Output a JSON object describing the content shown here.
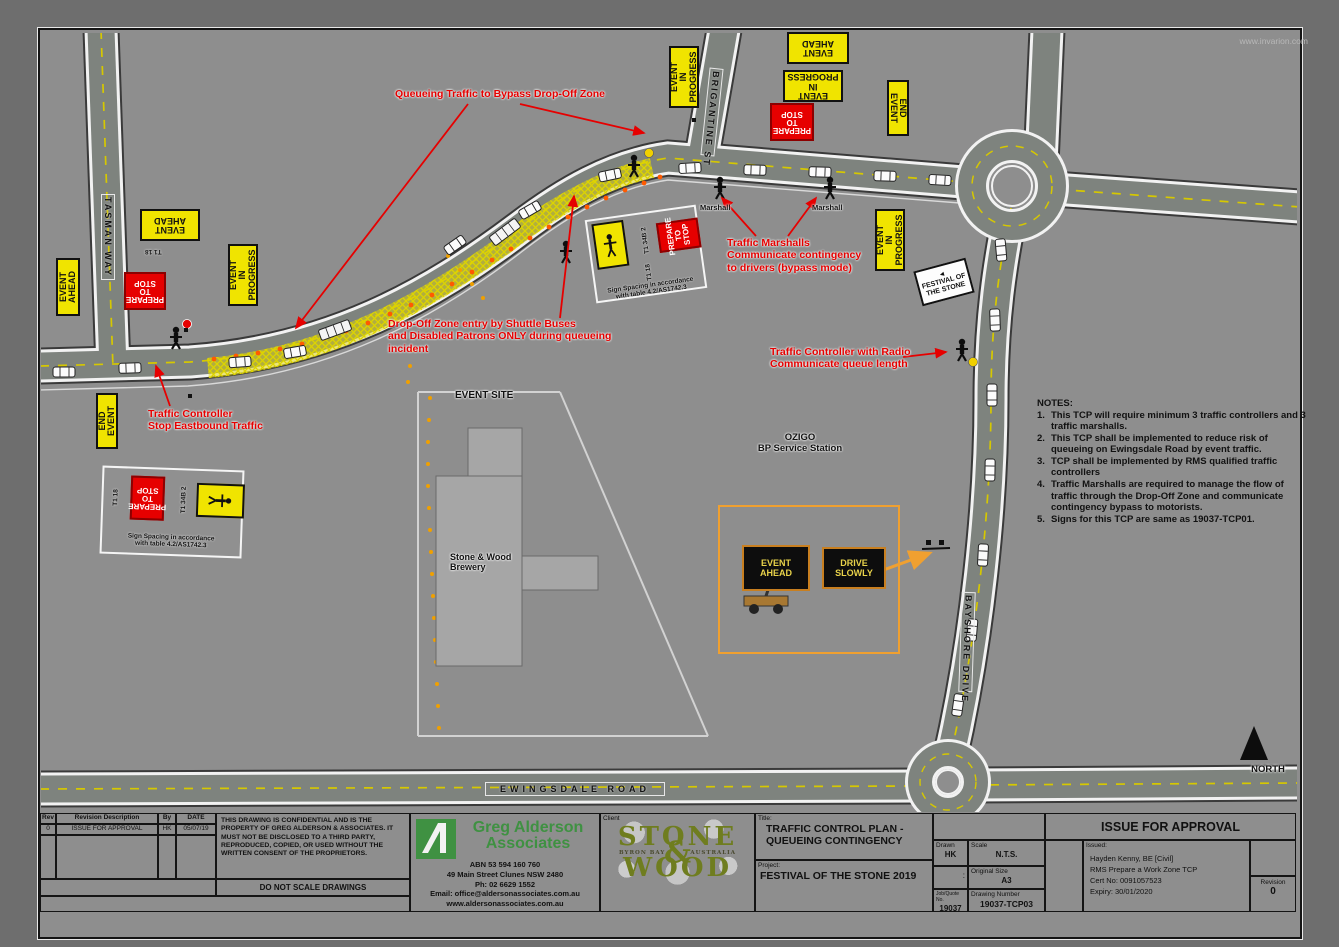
{
  "page": {
    "watermark": "www.invarion.com",
    "north_label": "NORTH"
  },
  "map": {
    "roads": {
      "tasman": "TASMAN WAY",
      "brigantine": "BRIGANTINE ST",
      "bayshore": "BAYSHORE DRIVE",
      "ewingsdale": "EWINGSDALE ROAD"
    },
    "site": {
      "event_site": "EVENT SITE",
      "brewery_l1": "Stone & Wood",
      "brewery_l2": "Brewery",
      "ozigo": "OZIGO",
      "bp": "BP Service Station"
    },
    "annotations": {
      "queueing": "Queueing Traffic to Bypass Drop-Off Zone",
      "dropoff_l1": "Drop-Off Zone entry by Shuttle Buses",
      "dropoff_l2": "and Disabled Patrons ONLY during queueing",
      "dropoff_l3": "incident",
      "tc_stop_l1": "Traffic Controller",
      "tc_stop_l2": "Stop Eastbound Traffic",
      "marshalls_l1": "Traffic Marshalls",
      "marshalls_l2": "Communicate contingency",
      "marshalls_l3": "to drivers (bypass mode)",
      "tc_radio_l1": "Traffic Controller with Radio",
      "tc_radio_l2": "Communicate queue length",
      "marshall": "Marshall"
    },
    "signs": {
      "event_ahead": {
        "l1": "EVENT",
        "l2": "AHEAD"
      },
      "event_in_progress": {
        "l1": "EVENT",
        "l2": "IN",
        "l3": "PROGRESS"
      },
      "prepare_to_stop": {
        "l1": "PREPARE",
        "l2": "TO",
        "l3": "STOP"
      },
      "end_event": {
        "l1": "END",
        "l2": "EVENT"
      },
      "festival": {
        "arrow": "◄",
        "l1": "FESTIVAL OF",
        "l2": "THE STONE"
      },
      "vms_event": {
        "l1": "EVENT",
        "l2": "AHEAD"
      },
      "vms_drive": {
        "l1": "DRIVE",
        "l2": "SLOWLY"
      },
      "t1_18": "T1 18",
      "t1_34b": "T1 34B 2",
      "spacing_l1": "Sign Spacing in accordance",
      "spacing_l2": "with table 4.2/AS1742.3"
    },
    "notes": {
      "heading": "NOTES:",
      "items": [
        "This TCP will require minimum 3 traffic controllers and 3 traffic marshalls.",
        "This TCP shall be implemented to reduce risk of queueing on Ewingsdale Road by event traffic.",
        "TCP shall be implemented by RMS qualified traffic controllers",
        "Traffic Marshalls are required to manage the flow of traffic through the Drop-Off Zone and communicate contingency bypass to motorists.",
        "Signs for this TCP are same as 19037-TCP01."
      ]
    }
  },
  "titleblock": {
    "revtable": {
      "headers": [
        "Rev",
        "Revision Description",
        "By",
        "DATE"
      ],
      "row0": {
        "rev": "0",
        "desc": "ISSUE FOR APPROVAL",
        "by": "HK",
        "date": "05/07/19"
      }
    },
    "disclaimer": "THIS DRAWING IS CONFIDENTIAL AND IS THE PROPERTY OF GREG ALDERSON & ASSOCIATES. IT MUST NOT BE DISCLOSED TO A THIRD PARTY, REPRODUCED, COPIED, OR USED WITHOUT THE WRITTEN CONSENT OF THE PROPRIETORS.",
    "no_scale": "DO NOT SCALE DRAWINGS",
    "company": {
      "name1": "Greg Alderson",
      "name2": "Associates",
      "abn": "ABN 53 594 160 760",
      "address": "49 Main Street Clunes NSW 2480",
      "phone": "Ph: 02 6629 1552",
      "email": "Email: office@aldersonassociates.com.au",
      "web": "www.aldersonassociates.com.au"
    },
    "client_label": "Client",
    "sw_logo": {
      "stone": "STONE",
      "amp": "&",
      "wood": "WOOD",
      "tag_l": "BYRON BAY",
      "tag_r": "AUSTRALIA"
    },
    "title_label": "Title:",
    "title_l1": "TRAFFIC CONTROL PLAN -",
    "title_l2": "QUEUEING CONTINGENCY",
    "project_label": "Project:",
    "project": "FESTIVAL OF THE STONE 2019",
    "fields": {
      "drawn_label": "Drawn",
      "drawn": "HK",
      "scale_label": "Scale",
      "scale": "N.T.S.",
      "colon": ":",
      "size_label": "Original Size",
      "size": "A3",
      "job_label": "Job/Quote No.",
      "job": "19037",
      "dwg_label": "Drawing Number",
      "dwg": "19037-TCP03"
    },
    "approval": {
      "banner": "ISSUE FOR APPROVAL",
      "issued_label": "Issued:",
      "line1": "Hayden Kenny, BE [Civil]",
      "line2": "RMS Prepare a Work Zone TCP",
      "line3": "Cert No: 0091057523",
      "line4": "Expiry: 30/01/2020",
      "revision_label": "Revision",
      "revision": "0"
    }
  },
  "colors": {
    "sign_yellow": "#f0e400",
    "sign_red": "#e60000",
    "annotation_red": "#e60000",
    "road_fill": "#7e837e",
    "zone_yellow": "#e6da00",
    "cone_orange": "#ff5a00",
    "vms_orange": "#f0a030",
    "ga_green": "#3f9142",
    "sw_olive": "#6f7d1f"
  }
}
